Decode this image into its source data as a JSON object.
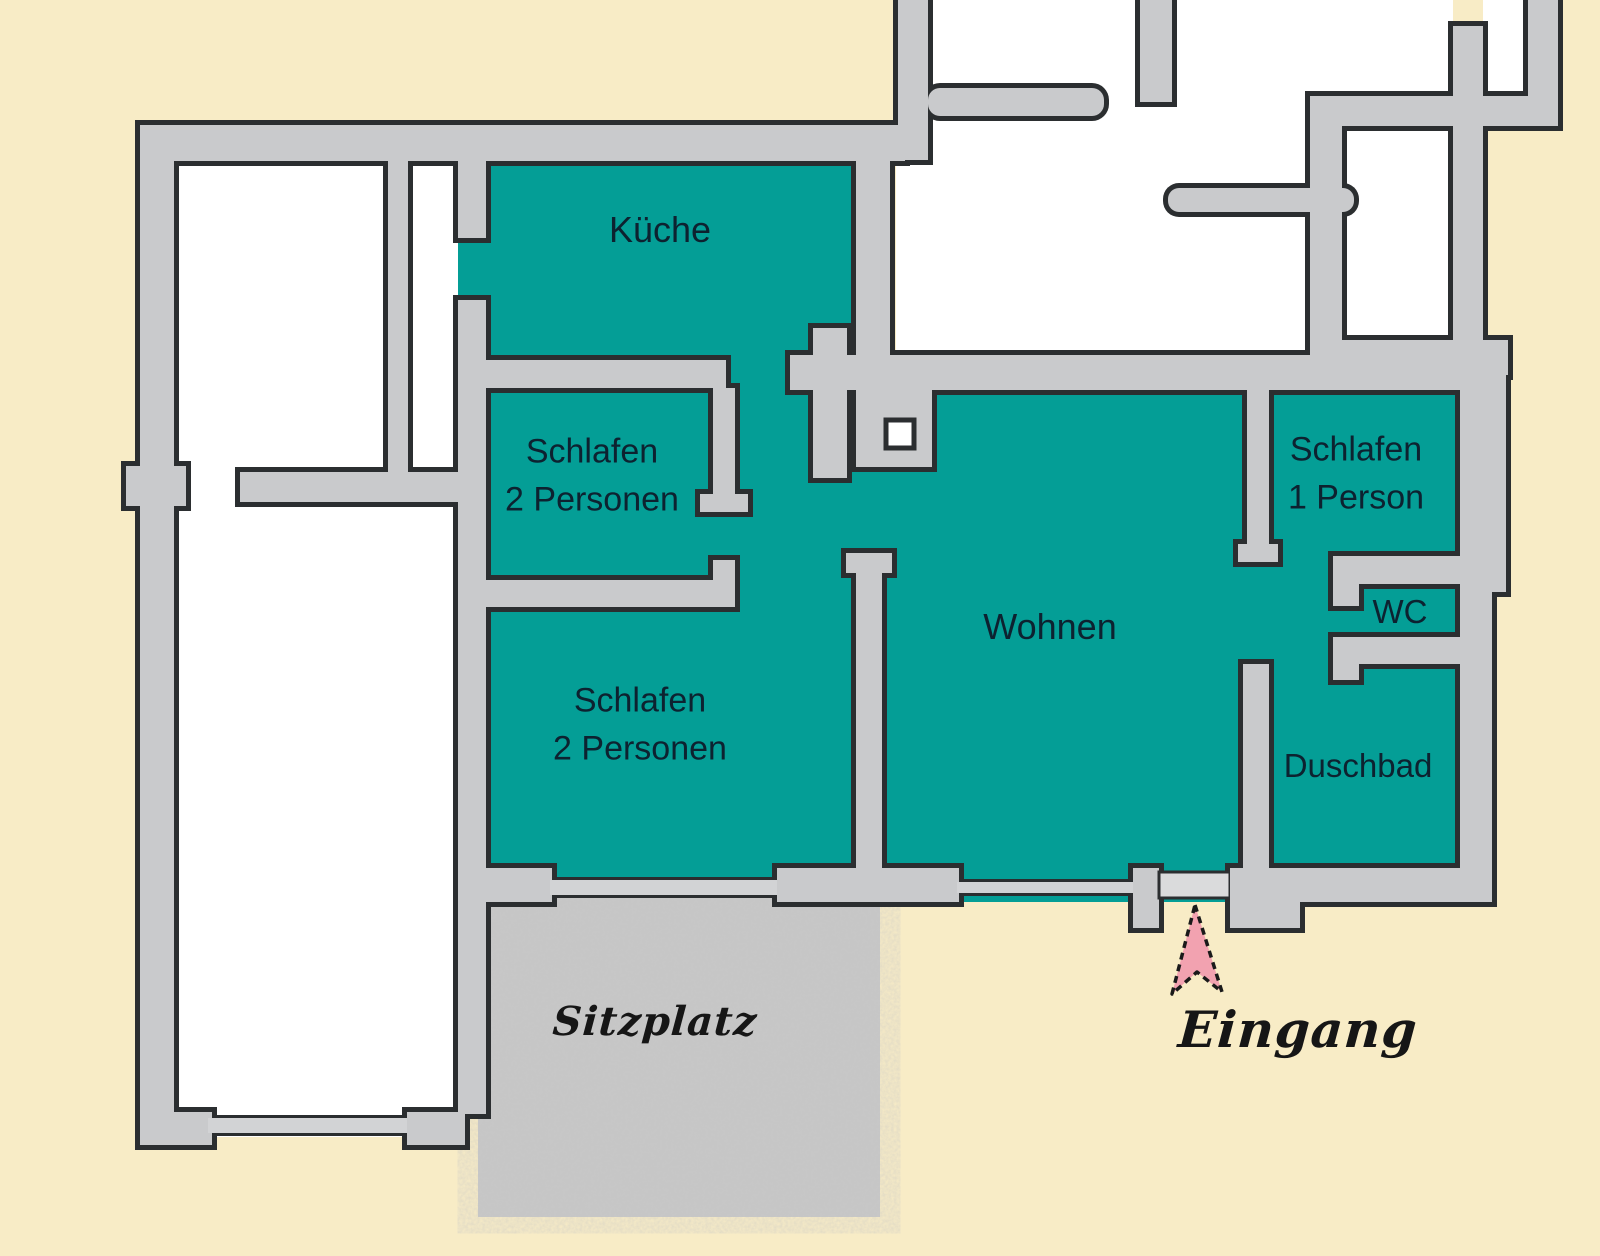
{
  "plan": {
    "title": "apartment-floor-plan",
    "rooms": [
      {
        "id": "kueche",
        "label": "Küche"
      },
      {
        "id": "schlafen-2-oben",
        "label": "Schlafen",
        "label2": "2 Personen"
      },
      {
        "id": "schlafen-2-unten",
        "label": "Schlafen",
        "label2": "2 Personen"
      },
      {
        "id": "wohnen",
        "label": "Wohnen"
      },
      {
        "id": "schlafen-1",
        "label": "Schlafen",
        "label2": "1 Person"
      },
      {
        "id": "wc",
        "label": "WC"
      },
      {
        "id": "duschbad",
        "label": "Duschbad"
      }
    ],
    "outdoor": {
      "sitzplatz_label": "Sitzplatz",
      "eingang_label": "Eingang",
      "eingang_arrow": "up-arrow"
    },
    "colors": {
      "room_fill": "#049e96",
      "wall_fill": "#c9cacc",
      "wall_outline": "#2b2e30",
      "background": "#f8ecc6",
      "patio_fill": "#c7c7c7",
      "label_ink": "#0d2230",
      "script_ink": "#161616",
      "arrow_fill": "#f2a2b0",
      "door_fill": "#dadbdc"
    }
  }
}
